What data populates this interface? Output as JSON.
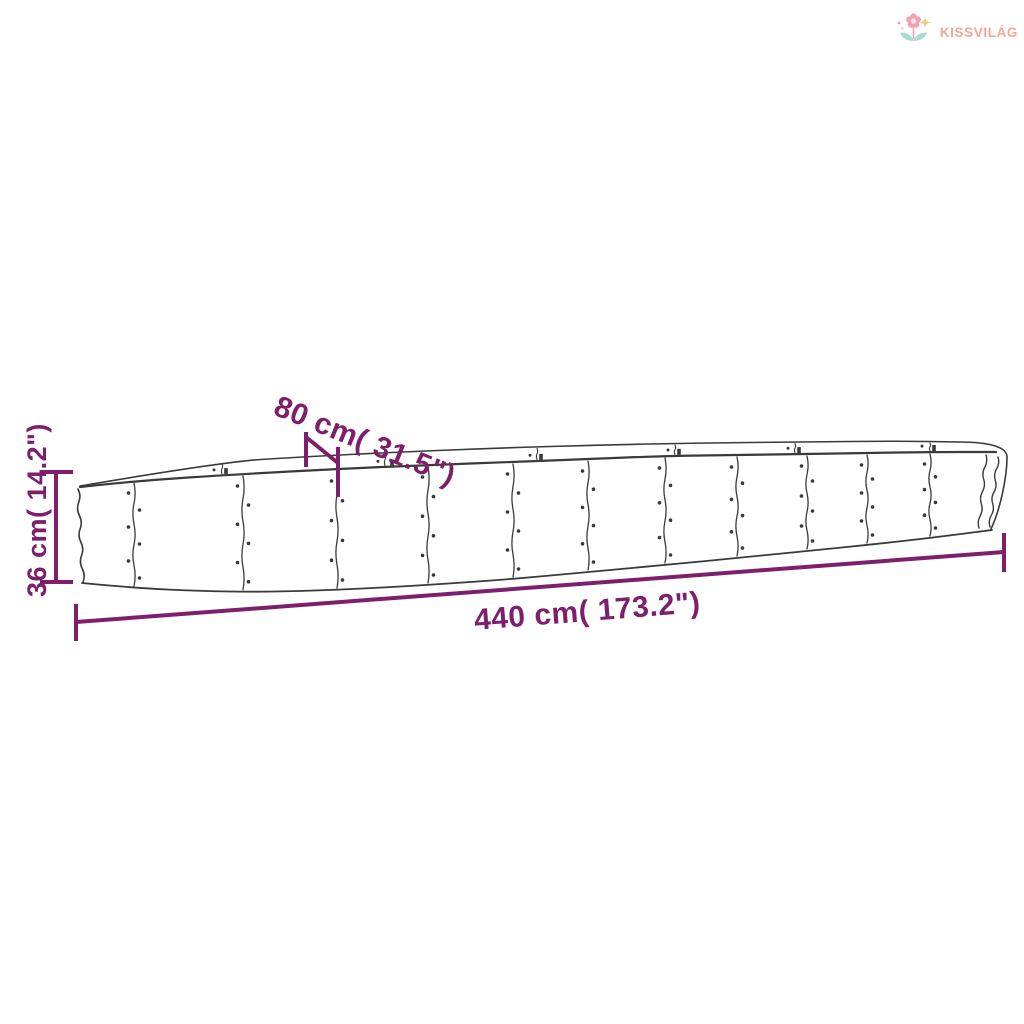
{
  "logo": {
    "brand": "KISSVILÁG",
    "colors": {
      "text": "#F2A796",
      "flower": "#F49FB4",
      "flower_center": "#FCE7EC",
      "leaves": "#ABDAD0",
      "sparkle": "#F6C87E"
    }
  },
  "diagram": {
    "length_label": "440 cm( 173.2\")",
    "width_label": "80 cm( 31.5\")",
    "height_label": "36 cm( 14.2\")",
    "colors": {
      "dimension": "#7D1F6C",
      "outline": "#3A3A3A",
      "background": "#FFFFFF"
    }
  }
}
